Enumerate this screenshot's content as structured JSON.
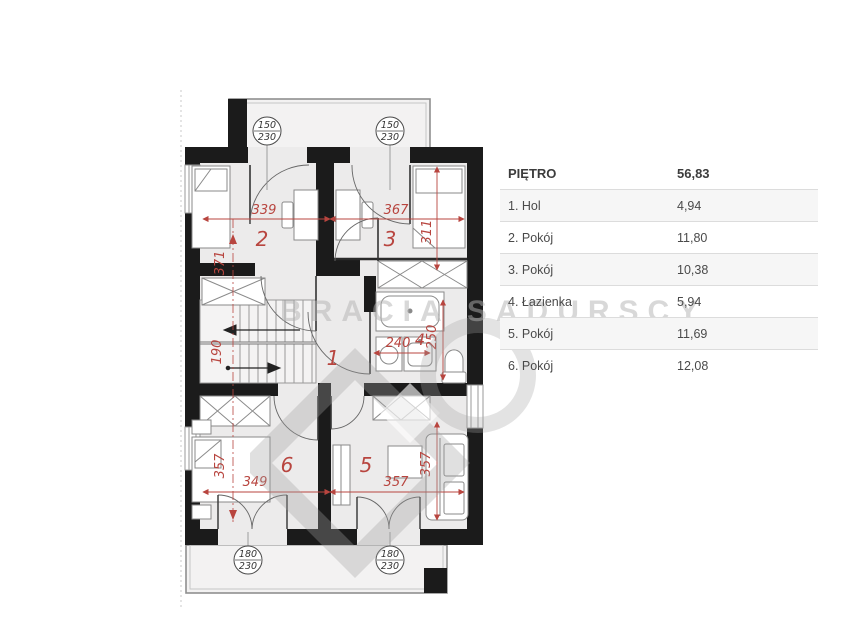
{
  "legend": {
    "header": {
      "label": "PIĘTRO",
      "value": "56,83"
    },
    "rows": [
      {
        "name": "1. Hol",
        "value": "4,94"
      },
      {
        "name": "2. Pokój",
        "value": "11,80"
      },
      {
        "name": "3. Pokój",
        "value": "10,38"
      },
      {
        "name": "4. Łazienka",
        "value": "5,94"
      },
      {
        "name": "5. Pokój",
        "value": "11,69"
      },
      {
        "name": "6. Pokój",
        "value": "12,08"
      }
    ]
  },
  "floorplan": {
    "rooms": [
      "1",
      "2",
      "3",
      "4",
      "5",
      "6"
    ],
    "dimensions": {
      "room2_width": "339",
      "room3_width": "367",
      "room3_height": "311",
      "room2_height": "371",
      "stairs_width": "190",
      "bath_width": "240",
      "bath_height": "250",
      "room6_height": "357",
      "room6_width": "349",
      "room5_width": "357",
      "room5_height": "357"
    },
    "markers": [
      {
        "w": "150",
        "h": "230"
      },
      {
        "w": "150",
        "h": "230"
      },
      {
        "w": "180",
        "h": "230"
      },
      {
        "w": "180",
        "h": "230"
      }
    ],
    "watermark": {
      "text": "BRACIA SADURSCY"
    },
    "colors": {
      "dimension_red": "#b8453f",
      "wall_black": "#1b1b1b",
      "floor_gray": "#ecebeb"
    }
  }
}
